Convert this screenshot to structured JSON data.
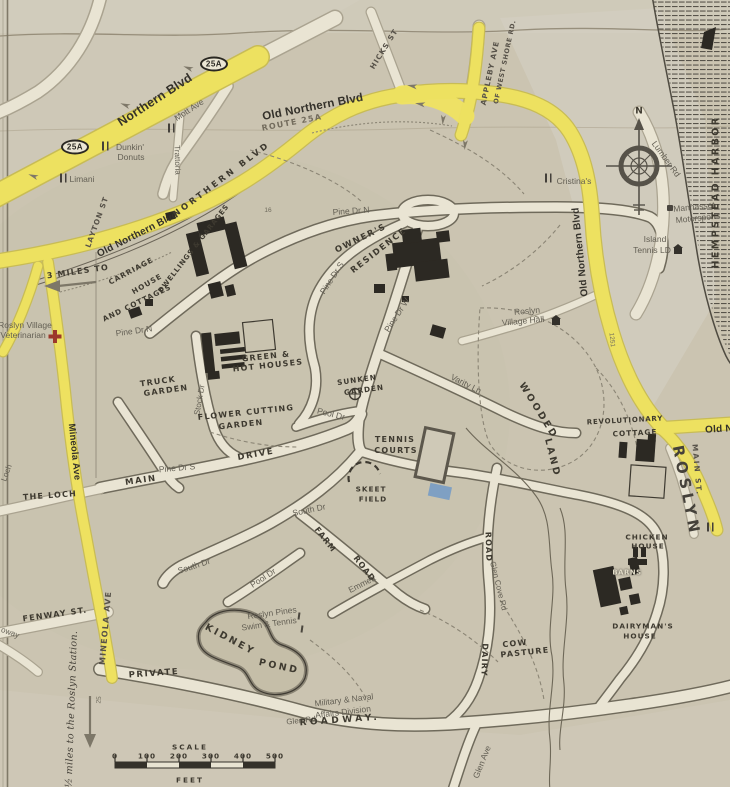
{
  "highways": {
    "northern_blvd": "Northern Blvd",
    "shield_ne": "25A",
    "shield_sw": "25A",
    "old_northern_top": "Old Northern Blvd",
    "route_25a": "ROUTE 25A",
    "old_northern_left": "Old Northern Blvd",
    "old_northern_right": "Old Northern Blvd",
    "old_northern_partial": "Old N",
    "three_miles_to": "3 MILES TO",
    "mineola_ave_upper": "Mineola Ave",
    "mineola_ave_lower": "MINEOLA AVE",
    "route_25": "25",
    "pole_number": "1251",
    "house_number": "16"
  },
  "streets": {
    "mott_ave": "Mott Ave",
    "hicks_st": "HICKS ST",
    "layton_st": "LAYTON ST",
    "appleby_ave": "APPLEBY AVE",
    "west_shore_rd": "OF WEST SHORE RD.",
    "lumber_rd": "Lumber Rd",
    "pine_dr_n_east": "Pine Dr N",
    "pine_dr_n_west": "Pine Dr N",
    "pine_dr_s_upper": "Pine Dr S",
    "pine_dr_s_lower": "Pine Dr S",
    "pine_dr_w": "Pine Dr W",
    "stock_dr": "Stock Dr",
    "varity_ln": "Varity Ln",
    "pool_dr_north": "Pool Dr",
    "pool_dr_south": "Pool Dr",
    "south_dr_east": "South Dr",
    "south_dr_west": "South Dr",
    "emmett": "Emmett",
    "glen_cove_rd": "Glen Cove Rd",
    "glen_ave": "Glen Ave",
    "glen_rd": "Glen Rd",
    "fenway_st": "FENWAY ST.",
    "street_fragment": "oway",
    "the_loch": "THE LOCH",
    "loch_fragment": "Loch",
    "main_st": "MAIN ST.",
    "roslyn": "ROSLYN"
  },
  "estate": {
    "old_northern_hand": "NORTHERN BLVD",
    "carriage_line1": "CARRIAGE",
    "carriage_line2": "HOUSE",
    "carriage_line3": "AND COTTAGES",
    "dwellings_garages": "DWELLINGS & GARAGES",
    "owners_line1": "OWNER'S",
    "owners_line2": "RESIDENCE",
    "greenhouses_line1": "GREEN &",
    "greenhouses_line2": "HOT HOUSES",
    "truck_line1": "TRUCK",
    "truck_line2": "GARDEN",
    "flower_line1": "FLOWER CUTTING",
    "flower_line2": "GARDEN",
    "sunken_line1": "SUNKEN",
    "sunken_line2": "GARDEN",
    "tennis_line1": "TENNIS",
    "tennis_line2": "COURTS",
    "skeet_line1": "SKEET",
    "skeet_line2": "FIELD",
    "wooded_line1": "WOODED",
    "wooded_line2": "LAND",
    "main_drive_1": "MAIN",
    "main_drive_2": "DRIVE",
    "farm_road_1": "FARM",
    "farm_road_2": "ROAD",
    "dairy_road_1": "ROAD",
    "dairy_road_2": "DAIRY",
    "cow_line1": "COW",
    "cow_line2": "PASTURE",
    "chicken_line1": "CHICKEN",
    "chicken_line2": "HOUSE",
    "barns": "BARNS",
    "dairyman_line1": "DAIRYMAN'S",
    "dairyman_line2": "HOUSE",
    "revolutionary_line1": "REVOLUTIONARY",
    "revolutionary_line2": "COTTAGE",
    "kidney_line1": "KIDNEY",
    "kidney_line2": "POND",
    "private": "PRIVATE",
    "roadway": "ROADWAY."
  },
  "pois": {
    "dunkin_line1": "Dunkin'",
    "dunkin_line2": "Donuts",
    "limani": "Limani",
    "trattoria": "Trattoria",
    "cristinas": "Cristina's",
    "village_hall_line1": "Roslyn",
    "village_hall_line2": "Village Hall",
    "vet_line1": "Roslyn Village",
    "vet_line2": "Veterinarian",
    "island_tennis_line1": "Island",
    "island_tennis_line2": "Tennis LD",
    "motorsports_line1": "Manhasset",
    "motorsports_line2": "Motorsports",
    "swim_tennis_line1": "Roslyn Pines",
    "swim_tennis_line2": "Swim & Tennis",
    "military_line1": "Military & Naval",
    "military_line2": "Affairs Division",
    "station_note": "½ miles to the Roslyn Station."
  },
  "misc": {
    "compass_north": "N",
    "harbor": "HEMPSTEAD HARBOR"
  },
  "scale": {
    "title": "SCALE",
    "unit": "FEET",
    "ticks": [
      "0",
      "100",
      "200",
      "300",
      "400",
      "500"
    ]
  }
}
